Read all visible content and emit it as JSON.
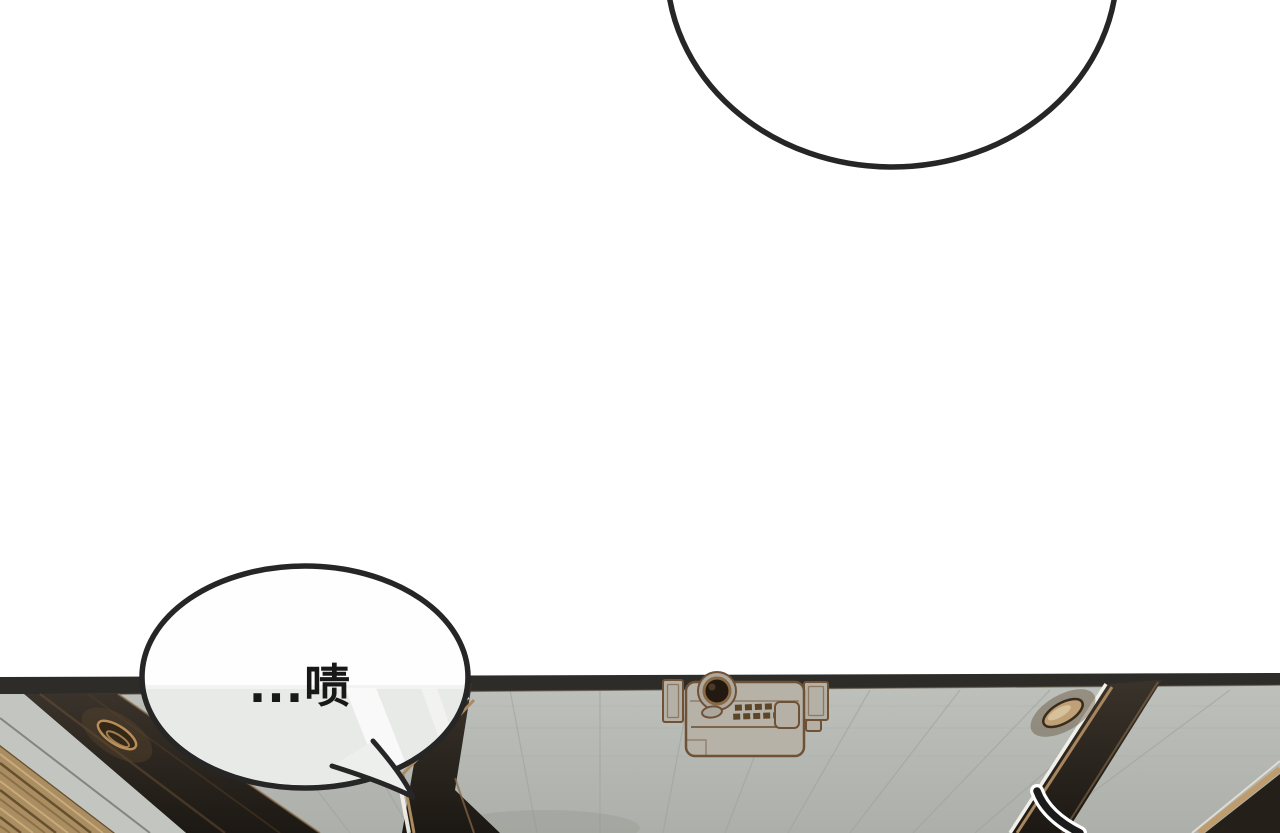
{
  "speech_bubble": {
    "text": "...啧"
  },
  "colors": {
    "outline": "#262626",
    "ceiling_gray": "#b8bbb6",
    "beam_dark": "#28221c",
    "wood_slats": "#aa8e62",
    "highlight_tan": "#b08c5f",
    "light_fixture_rim": "#b98d58",
    "top_band": "#2e2c28"
  }
}
